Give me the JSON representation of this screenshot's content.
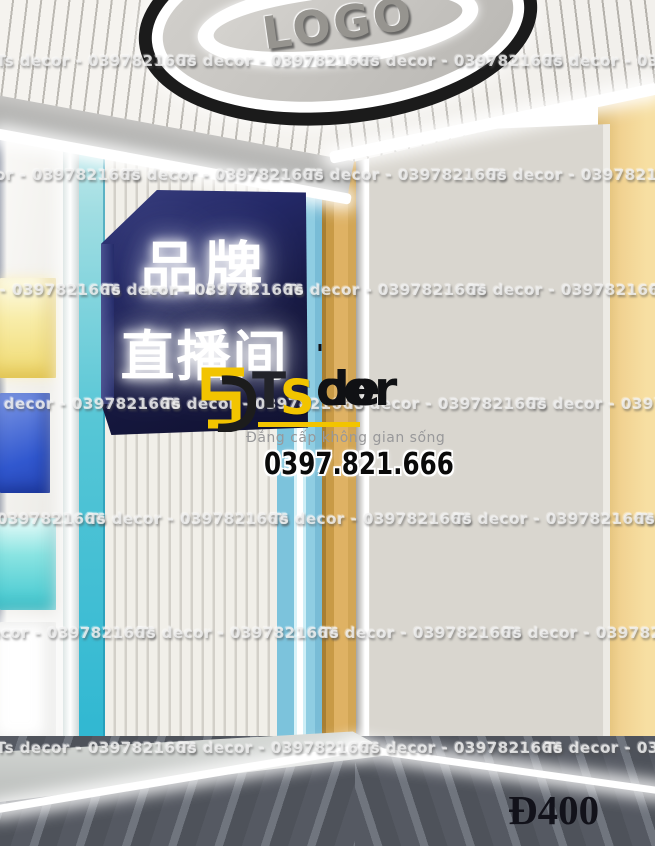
{
  "watermark": {
    "text": "Ts decor - 0397821666"
  },
  "ceiling_light": {
    "label": "LOGO"
  },
  "sign": {
    "line1": "品牌",
    "line2": "直播间"
  },
  "brand": {
    "t": "T",
    "s": "S",
    "name_before": "de",
    "name_tick": "'",
    "name_after": "cor",
    "tagline": "Đẳng cấp không gian sống",
    "phone": "0397.821.666"
  },
  "price_label": "Đ400",
  "grid_wall": {
    "rows": 15,
    "cols": 6,
    "lit_cells": [
      [
        0,
        4
      ],
      [
        1,
        3
      ],
      [
        3,
        2
      ],
      [
        4,
        1
      ],
      [
        6,
        1
      ],
      [
        8,
        2
      ],
      [
        9,
        3
      ],
      [
        10,
        0
      ],
      [
        11,
        4
      ],
      [
        12,
        5
      ],
      [
        13,
        1
      ],
      [
        13,
        4
      ],
      [
        14,
        5
      ]
    ]
  },
  "colors": {
    "accent_yellow": "#f2c400",
    "sign_navy": "#161840",
    "teal_panel": "#3fc6cf",
    "teal_deep": "#2fb7d2",
    "niche_blue": "#3158cf",
    "niche_yellow": "#f0da70",
    "corner_tan": "#dfb264",
    "wheat_wall": "#f1d291",
    "grid_cell_taupe": "#857f70",
    "floor_gray": "#5f636b"
  }
}
